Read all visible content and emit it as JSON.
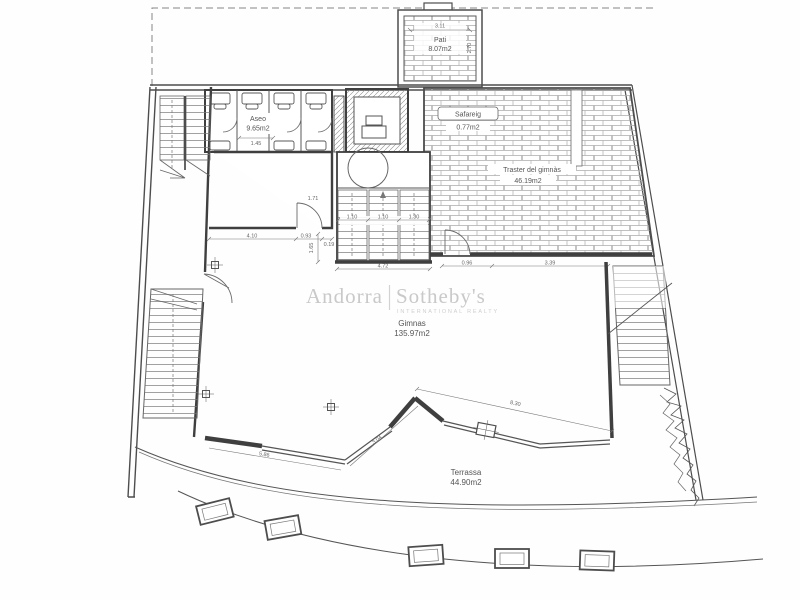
{
  "watermark": {
    "brand_left": "Andorra",
    "brand_right": "Sotheby's",
    "brand_sub": "INTERNATIONAL REALTY"
  },
  "rooms": {
    "pati": {
      "name": "Pati",
      "area": "8.07m2"
    },
    "aseo": {
      "name": "Aseo",
      "area": "9.65m2"
    },
    "safareig": {
      "name": "Safareig",
      "area": "0.77m2"
    },
    "traster": {
      "name": "Traster del gimnàs",
      "area": "46.19m2"
    },
    "gimnas": {
      "name": "Gimnas",
      "area": "135.97m2"
    },
    "terrassa": {
      "name": "Terrassa",
      "area": "44.90m2"
    }
  },
  "dims": {
    "pati_width": "3.11",
    "pati_depth": "2.70",
    "aseo_width": "1.45",
    "room_width": "4.10",
    "pass_a": "0.93",
    "pass_b": "0.19",
    "door_width": "1.71",
    "flight_1": "1.10",
    "flight_2": "1.10",
    "flight_3": "1.30",
    "stair_side": "1.65",
    "stair_width": "4.72",
    "corridor": "0.96",
    "traster_width": "3.39",
    "terrace_a": "5.86",
    "terrace_b": "3.04",
    "terrace_c": "8.30"
  },
  "colors": {
    "wall_line": "#4d4d4d",
    "thin_line": "#6a6a6a",
    "hatch": "#a8a8a8",
    "dim_text": "#666666",
    "watermark": "#c9c9c9",
    "background": "#fefefe"
  }
}
